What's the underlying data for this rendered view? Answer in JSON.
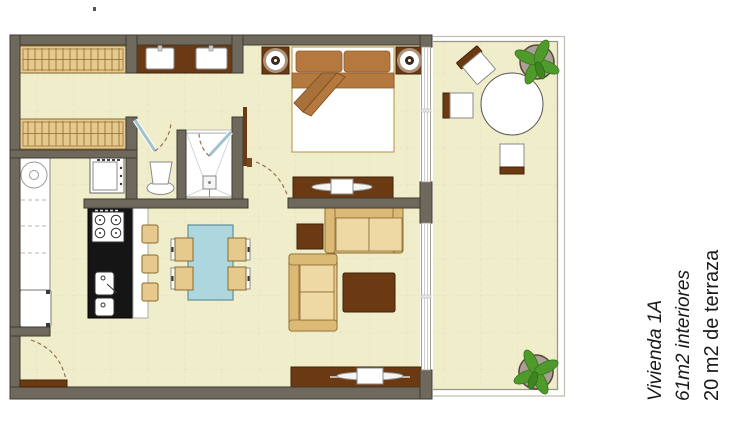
{
  "title_block": {
    "line1": "Vivienda 1A",
    "line2": "61m2 interiores",
    "line3": "20 m2 de terraza"
  },
  "plan_symbols": [
    "wardrobe",
    "double-sink-vanity",
    "toilet",
    "shower",
    "washing-machine",
    "fridge",
    "oven",
    "cooktop",
    "kitchen-island-sink",
    "bar-stool",
    "dining-table",
    "dining-chair",
    "sofa",
    "coffee-table",
    "side-table",
    "tv-console",
    "tv",
    "double-bed",
    "nightstand",
    "lamp",
    "dresser",
    "terrace-round-table",
    "terrace-chair",
    "potted-plant",
    "glass-sliding-door",
    "door-swing-arc"
  ],
  "colors": {
    "background": "#ffffff",
    "floor": "#f0edcb",
    "wall": "#6e695c",
    "wall-line": "#3e3a31",
    "wood-dark": "#6b3a12",
    "wood-dark-line": "#40220a",
    "tan": "#e6c98c",
    "tan-dark": "#dcb975",
    "tan-light": "#eed9a4",
    "tan-line": "#8a6a30",
    "bed-brown": "#b5793f",
    "table-blue": "#aed6de",
    "table-blue-line": "#5d8f99",
    "plant-green": "#4e9b2c",
    "door-teal": "#9fc4cc",
    "arc-brown": "#8a6a4a",
    "tile-line": "#dcc9c0",
    "glass-line": "#9a958a",
    "text": "#1a1a1a"
  }
}
